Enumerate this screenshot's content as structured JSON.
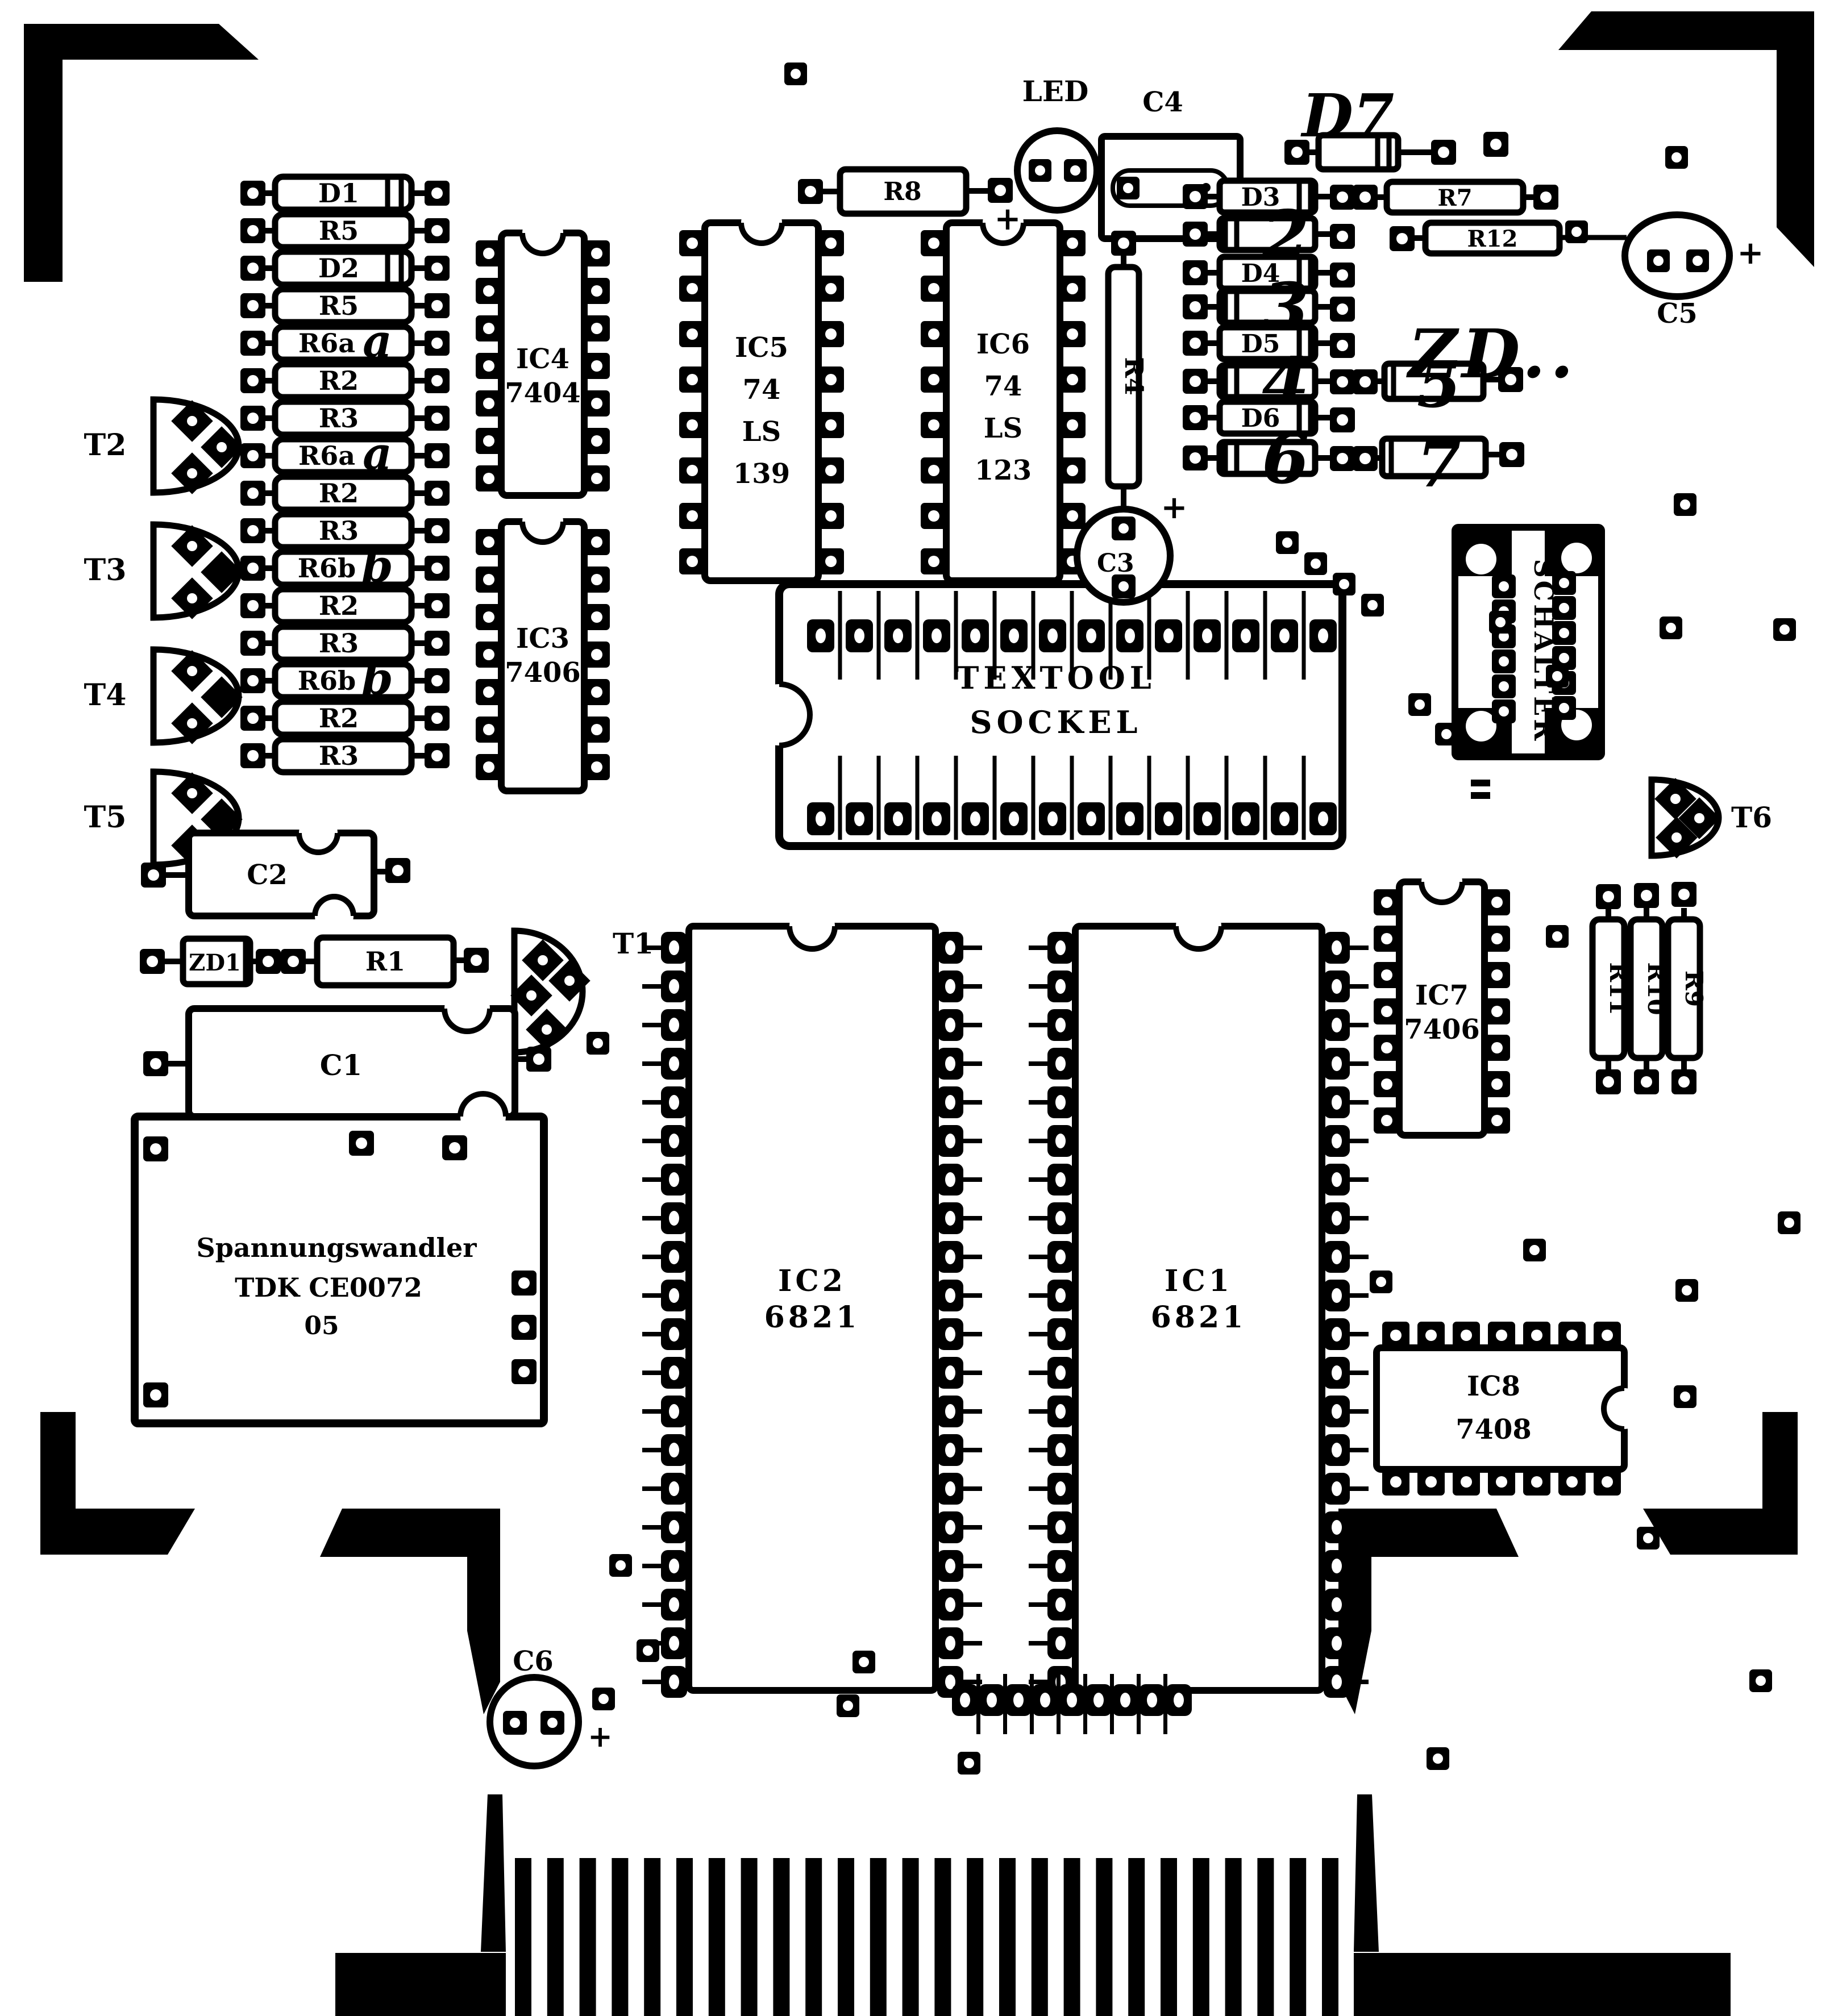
{
  "left_column": {
    "labels": [
      "D1",
      "R5",
      "D2",
      "R5",
      "R6a",
      "R2",
      "R3",
      "R6a",
      "R2",
      "R3",
      "R6b",
      "R2",
      "R3",
      "R6b",
      "R2",
      "R3"
    ]
  },
  "transistors": {
    "t1": "T1",
    "t2": "T2",
    "t3": "T3",
    "t4": "T4",
    "t5": "T5",
    "t6": "T6"
  },
  "ics": {
    "ic4": [
      "IC4",
      "7404"
    ],
    "ic3": [
      "IC3",
      "7406"
    ],
    "ic5": [
      "IC5",
      "74",
      "LS",
      "139"
    ],
    "ic6": [
      "IC6",
      "74",
      "LS",
      "123"
    ],
    "ic7": [
      "IC7",
      "7406"
    ],
    "ic8": [
      "IC8",
      "7408"
    ],
    "ic2": [
      "IC2",
      "6821"
    ],
    "ic1": [
      "IC1",
      "6821"
    ]
  },
  "socket": {
    "lines": [
      "TEXTOOL",
      "SOCKEL"
    ]
  },
  "switch_label": "SCHALTER",
  "converter": {
    "lines": [
      "Spannungswandler",
      "TDK CE0072",
      "05"
    ]
  },
  "capacitors": {
    "c1": "C1",
    "c2": "C2",
    "c3": "C3",
    "c4": "C4",
    "c5": "C5",
    "c6": "C6"
  },
  "led_label": "LED",
  "resistors": {
    "r1": "R1",
    "r4": "R4",
    "r7": "R7",
    "r8": "R8",
    "r9": "R9",
    "r10": "R10",
    "r11": "R11",
    "r12": "R12"
  },
  "diodes": {
    "d3": "D3",
    "d4": "D4",
    "d5": "D5",
    "d6": "D6",
    "d7": "D7",
    "zd1": "ZD1"
  },
  "handwritten": {
    "row2": "2",
    "row3": "3",
    "row4": "4",
    "row6": "6",
    "comp5": "5",
    "comp7": "7",
    "zd_note": "ZD..",
    "suffix_a": "a",
    "suffix_b": "b"
  },
  "plus_mark": "+",
  "colors": {
    "ink": "#000000",
    "paper": "#ffffff"
  }
}
